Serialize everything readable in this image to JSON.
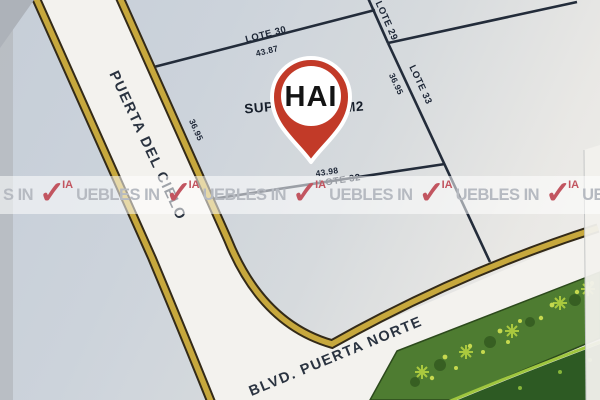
{
  "map": {
    "pin": {
      "label": "HAI"
    },
    "parcel": {
      "surface_prefix": "SUP",
      "surface_suffix": "M2"
    },
    "lots": {
      "lote30": "LOTE 30",
      "lote29": "LOTE 29",
      "lote32": "LOTE 32",
      "lote33": "LOTE 33"
    },
    "dimensions": {
      "top": "43.87",
      "bottom": "43.98",
      "left": "36.95",
      "right": "36.95"
    },
    "streets": {
      "cielo": "PUERTA DEL CIELO",
      "blvd": "BLVD. PUERTA NORTE"
    },
    "colors": {
      "pin_red": "#c23a28",
      "road_yellow": "#c7a83d",
      "road_edge_dark": "#332a18",
      "lot_line": "#232c3a",
      "median_green": "#4e7c31",
      "paper_blue_gray": "#ccd3db"
    }
  },
  "watermark": {
    "lead": "S IN",
    "check": "✓",
    "ia": "IA",
    "text": "UEBLES IN",
    "repeat": 7,
    "red": "#c25560",
    "gray": "#b6bac1"
  }
}
